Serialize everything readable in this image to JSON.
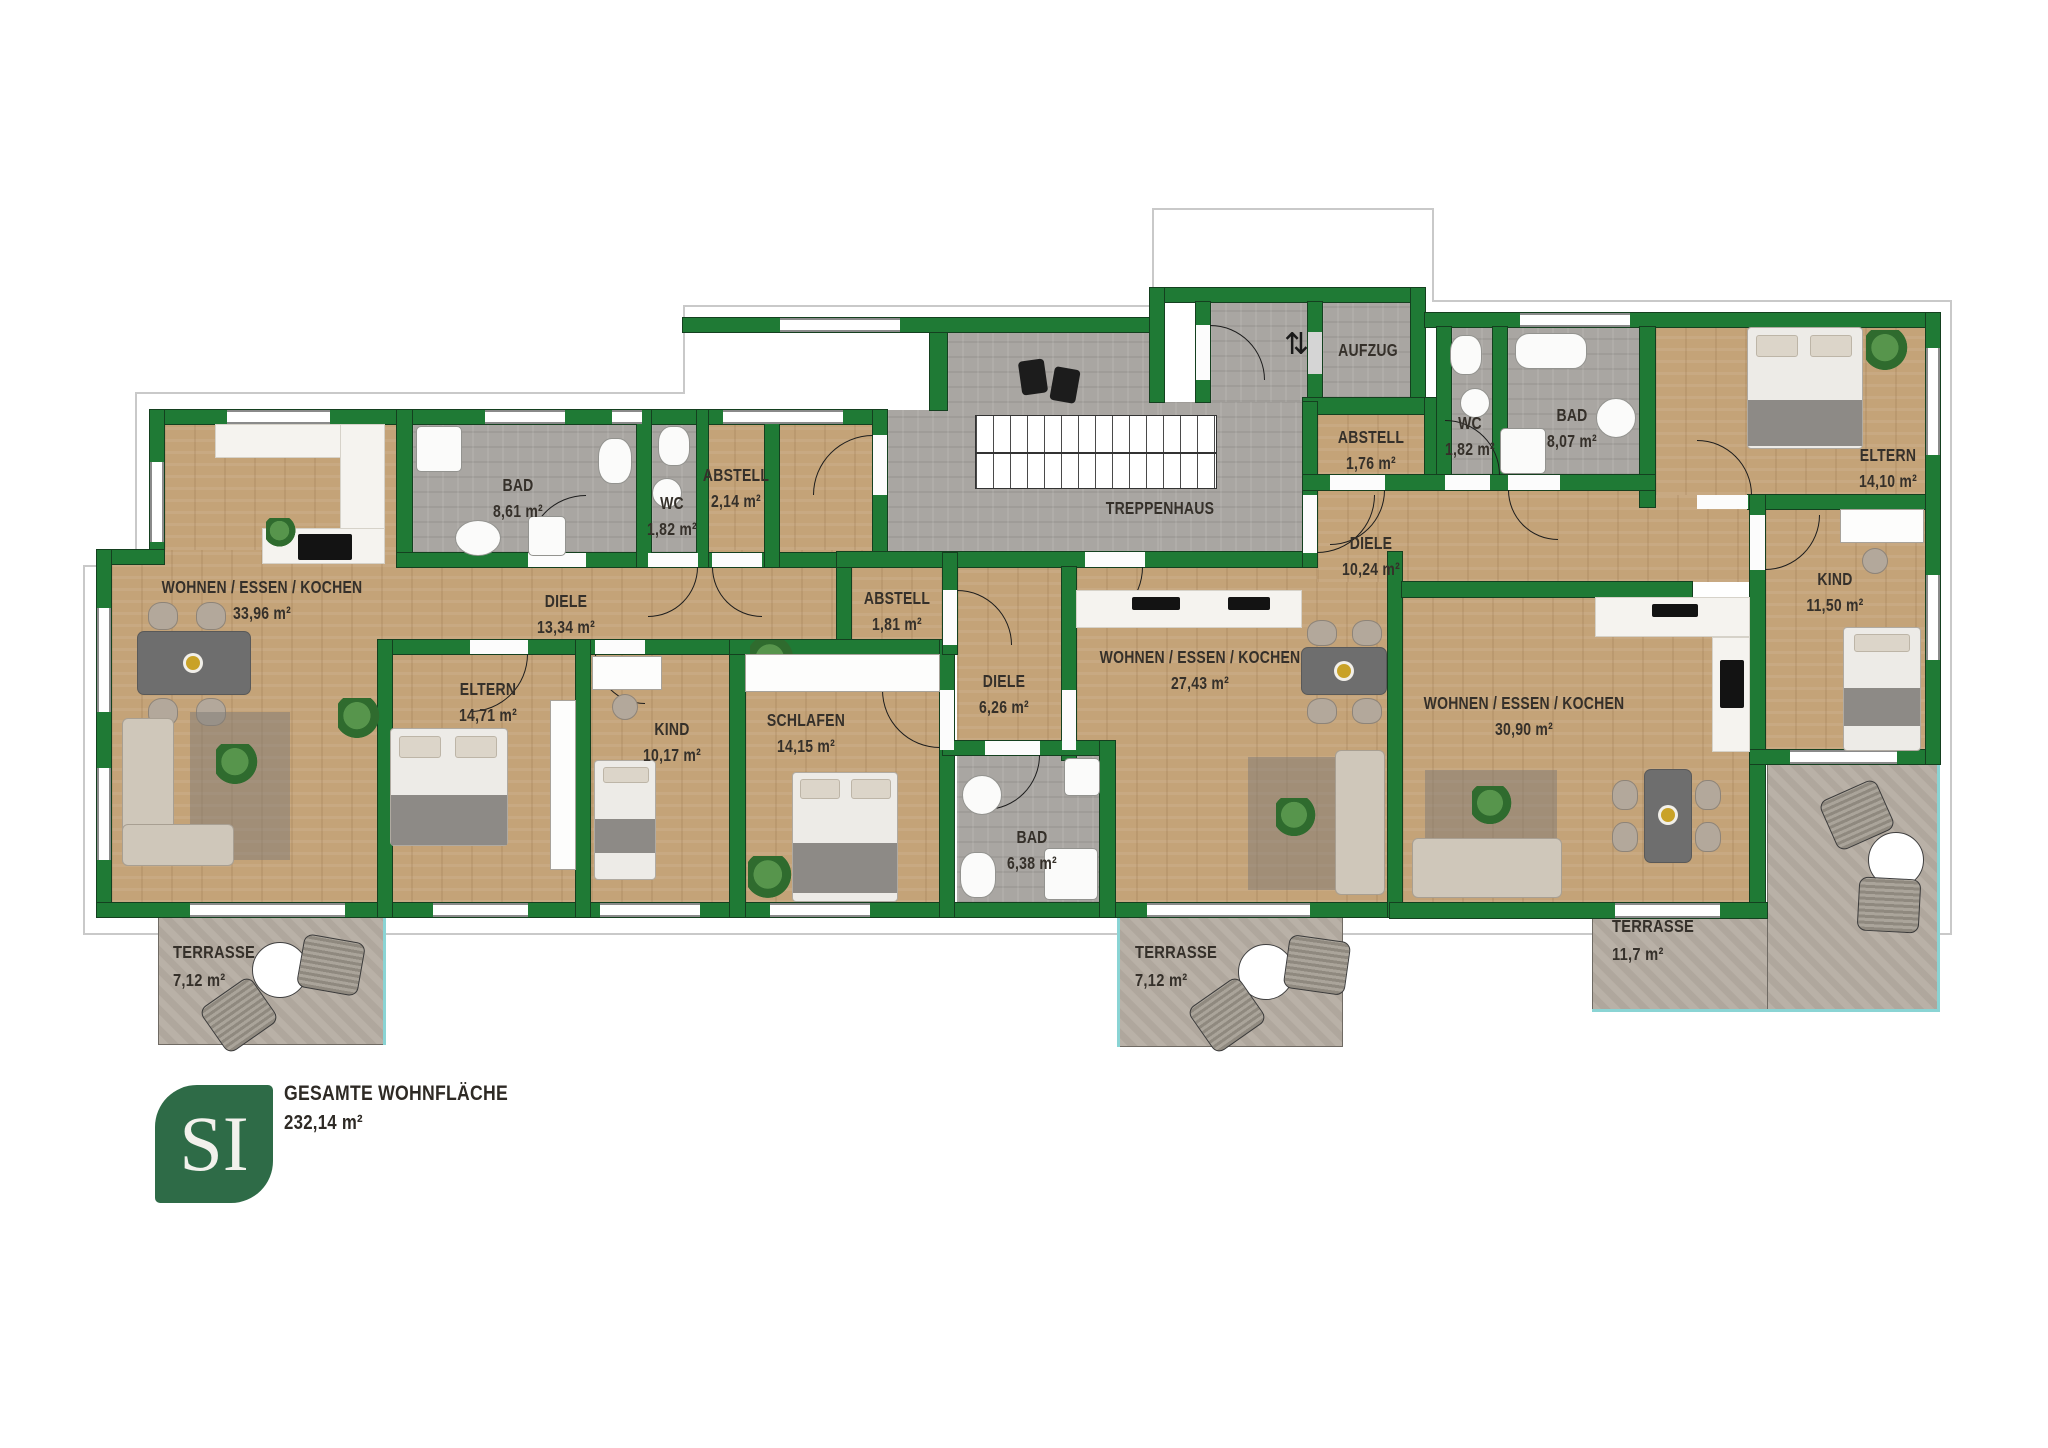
{
  "plan": {
    "rooms": [
      {
        "name": "WOHNEN / ESSEN / KOCHEN",
        "area": "33,96 m²"
      },
      {
        "name": "BAD",
        "area": "8,61 m²"
      },
      {
        "name": "WC",
        "area": "1,82 m²"
      },
      {
        "name": "ABSTELL",
        "area": "2,14 m²"
      },
      {
        "name": "DIELE",
        "area": "13,34 m²"
      },
      {
        "name": "ELTERN",
        "area": "14,71 m²"
      },
      {
        "name": "KIND",
        "area": "10,17 m²"
      },
      {
        "name": "SCHLAFEN",
        "area": "14,15 m²"
      },
      {
        "name": "ABSTELL",
        "area": "1,81 m²"
      },
      {
        "name": "DIELE",
        "area": "6,26 m²"
      },
      {
        "name": "BAD",
        "area": "6,38 m²"
      },
      {
        "name": "WOHNEN / ESSEN / KOCHEN",
        "area": "27,43 m²"
      },
      {
        "name": "TREPPENHAUS",
        "area": ""
      },
      {
        "name": "AUFZUG",
        "area": ""
      },
      {
        "name": "ABSTELL",
        "area": "1,76 m²"
      },
      {
        "name": "WC",
        "area": "1,82 m²"
      },
      {
        "name": "BAD",
        "area": "8,07 m²"
      },
      {
        "name": "DIELE",
        "area": "10,24 m²"
      },
      {
        "name": "ELTERN",
        "area": "14,10 m²"
      },
      {
        "name": "KIND",
        "area": "11,50 m²"
      },
      {
        "name": "WOHNEN / ESSEN / KOCHEN",
        "area": "30,90 m²"
      },
      {
        "name": "TERRASSE",
        "area": "7,12 m²"
      },
      {
        "name": "TERRASSE",
        "area": "7,12 m²"
      },
      {
        "name": "TERRASSE",
        "area": "11,7 m²"
      }
    ],
    "footer": {
      "logo": "SI",
      "label": "GESAMTE WOHNFLÄCHE",
      "value": "232,14 m²"
    },
    "icons": {
      "elevator": "⇅"
    },
    "colors": {
      "wall": "#1f7a35",
      "wood": "#c4a378",
      "tile": "#a9a6a2",
      "terrace": "#b5aca2",
      "logo": "#2e6b47",
      "terrace_edge": "#8ad4d4"
    }
  }
}
